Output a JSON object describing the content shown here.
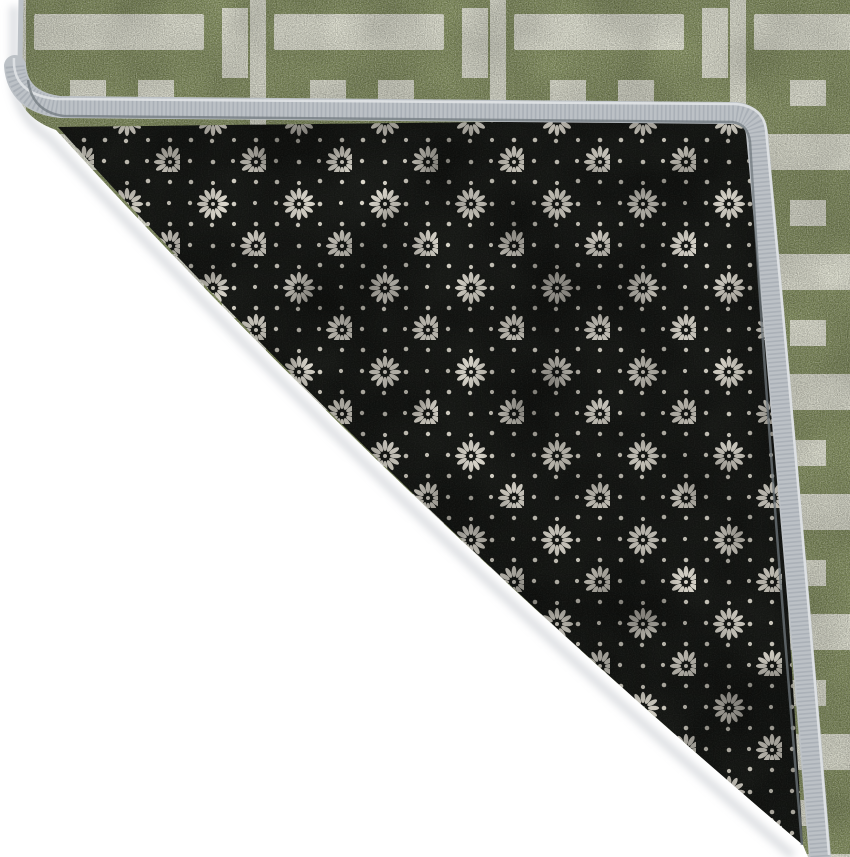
{
  "scene": {
    "description": "Close-up product photo of a sage green area rug with an interlocking cream rectangle lattice pattern; its corner is folded over to reveal a black non-slip felt backing covered with a grid of small white pin dots and twelve-petal daisy rosettes; the edge is finished with a light gray serged binding; photographed on a plain white background.",
    "object": "area rug with corner folded to show backing",
    "background": "white studio floor"
  },
  "rug": {
    "front": {
      "label": "rug front pile",
      "pattern": "interlocking cream bars, squares and rectangles on heathered sage green"
    },
    "back": {
      "label": "rug backing",
      "pattern": "white pin-dot grid with daisy rosette motifs on black felt"
    },
    "binding": {
      "label": "serged edge binding",
      "color_name": "light silver gray"
    }
  },
  "palette": {
    "floor_white": "#ffffff",
    "front_green": "#84915c",
    "front_green_dark": "#4e5a35",
    "front_cream": "#e9ead9",
    "binding_gray": "#bcc1c6",
    "binding_stipple": "#949ca3",
    "binding_highlight": "#e0e3e6",
    "binding_shade": "#70787e",
    "backing_black": "#171916",
    "backing_dot": "#ddd9cd",
    "backing_petal": "#e3dfd4",
    "fold_shadow": "#c7cbd0"
  }
}
